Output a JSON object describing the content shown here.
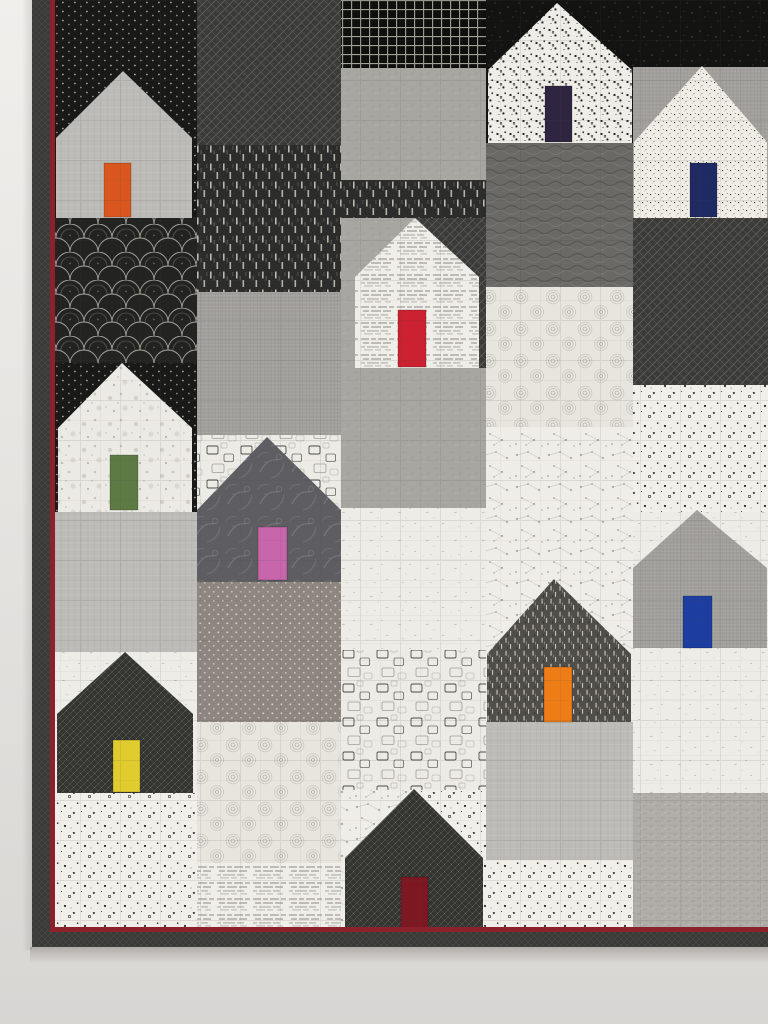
{
  "scene": {
    "description": "Photograph of a modern patchwork quilt hanging on a pale wall: rows of house blocks pieced from black, white and gray printed fabrics, each house with a single bright colored door; dark binding with thin dark-red piping on left and bottom edges",
    "wall": {
      "top_color": "#f0efec",
      "bottom_color": "#d8d6d3"
    },
    "piping_color": "#8c212c",
    "quilt": {
      "cells": [
        {
          "x": 55,
          "y": 0,
          "w": 142,
          "h": 218,
          "fabric": "blackDots"
        },
        {
          "x": 55,
          "y": 218,
          "w": 142,
          "h": 145,
          "fabric": "clamshell"
        },
        {
          "x": 55,
          "y": 363,
          "w": 142,
          "h": 149,
          "fabric": "blackDots"
        },
        {
          "x": 55,
          "y": 512,
          "w": 142,
          "h": 140,
          "fabric": "lightGrayX"
        },
        {
          "x": 55,
          "y": 652,
          "w": 142,
          "h": 141,
          "fabric": "whiteFleck"
        },
        {
          "x": 55,
          "y": 793,
          "w": 142,
          "h": 135,
          "fabric": "confetti"
        },
        {
          "x": 197,
          "y": 0,
          "w": 144,
          "h": 145,
          "fabric": "diagCross"
        },
        {
          "x": 197,
          "y": 145,
          "w": 144,
          "h": 147,
          "fabric": "bamboo"
        },
        {
          "x": 197,
          "y": 292,
          "w": 144,
          "h": 143,
          "fabric": "grayLinen"
        },
        {
          "x": 197,
          "y": 435,
          "w": 144,
          "h": 147,
          "fabric": "squaresWhite"
        },
        {
          "x": 197,
          "y": 582,
          "w": 144,
          "h": 140,
          "fabric": "taupeDots"
        },
        {
          "x": 197,
          "y": 722,
          "w": 144,
          "h": 141,
          "fabric": "swirl"
        },
        {
          "x": 197,
          "y": 863,
          "w": 144,
          "h": 65,
          "fabric": "textPrint"
        },
        {
          "x": 341,
          "y": 0,
          "w": 145,
          "h": 68,
          "fabric": "gridBlack"
        },
        {
          "x": 341,
          "y": 68,
          "w": 145,
          "h": 112,
          "fabric": "grayFleckMed"
        },
        {
          "x": 341,
          "y": 180,
          "w": 145,
          "h": 38,
          "fabric": "bamboo"
        },
        {
          "x": 341,
          "y": 218,
          "w": 74,
          "h": 150,
          "fabric": "grayFleckMed"
        },
        {
          "x": 415,
          "y": 218,
          "w": 71,
          "h": 150,
          "fabric": "diagCross"
        },
        {
          "x": 341,
          "y": 368,
          "w": 145,
          "h": 140,
          "fabric": "grayFleckMed"
        },
        {
          "x": 341,
          "y": 508,
          "w": 145,
          "h": 142,
          "fabric": "whiteFleck"
        },
        {
          "x": 341,
          "y": 650,
          "w": 145,
          "h": 140,
          "fabric": "squaresWhite"
        },
        {
          "x": 341,
          "y": 790,
          "w": 73,
          "h": 138,
          "fabric": "constellation"
        },
        {
          "x": 414,
          "y": 790,
          "w": 72,
          "h": 138,
          "fabric": "confetti"
        },
        {
          "x": 486,
          "y": 0,
          "w": 147,
          "h": 143,
          "fabric": "blackSpeckle"
        },
        {
          "x": 486,
          "y": 143,
          "w": 147,
          "h": 144,
          "fabric": "darkScribble"
        },
        {
          "x": 486,
          "y": 287,
          "w": 147,
          "h": 140,
          "fabric": "swirl"
        },
        {
          "x": 486,
          "y": 427,
          "w": 147,
          "h": 295,
          "fabric": "constellation"
        },
        {
          "x": 486,
          "y": 722,
          "w": 147,
          "h": 138,
          "fabric": "lightGrayX"
        },
        {
          "x": 486,
          "y": 860,
          "w": 147,
          "h": 68,
          "fabric": "confetti"
        },
        {
          "x": 633,
          "y": 0,
          "w": 135,
          "h": 67,
          "fabric": "blackSpeckle"
        },
        {
          "x": 633,
          "y": 67,
          "w": 135,
          "h": 151,
          "fabric": "grayLinen"
        },
        {
          "x": 633,
          "y": 218,
          "w": 135,
          "h": 167,
          "fabric": "diagCross"
        },
        {
          "x": 633,
          "y": 385,
          "w": 135,
          "h": 127,
          "fabric": "confetti"
        },
        {
          "x": 633,
          "y": 512,
          "w": 135,
          "h": 281,
          "fabric": "whiteFleck"
        },
        {
          "x": 633,
          "y": 793,
          "w": 135,
          "h": 135,
          "fabric": "grayDash"
        }
      ],
      "houses": [
        {
          "name": "house-1-orange-door",
          "xL": 56,
          "xR": 192,
          "peakX": 123,
          "peakY": 71,
          "eave": 138,
          "bottom": 218,
          "fabric": "lightGrayX",
          "door": {
            "x": 104,
            "y": 163,
            "w": 27,
            "h": 54,
            "color": "#d9571e"
          }
        },
        {
          "name": "house-2-purple-door",
          "xL": 488,
          "xR": 632,
          "peakX": 557,
          "peakY": 3,
          "eave": 70,
          "bottom": 143,
          "fabric": "confettiDense",
          "door": {
            "x": 545,
            "y": 86,
            "w": 27,
            "h": 56,
            "color": "#2f2540"
          }
        },
        {
          "name": "house-3-navy-door",
          "xL": 634,
          "xR": 767,
          "peakX": 702,
          "peakY": 66,
          "eave": 142,
          "bottom": 218,
          "fabric": "tinyDots",
          "door": {
            "x": 690,
            "y": 163,
            "w": 27,
            "h": 54,
            "color": "#1f2a63"
          }
        },
        {
          "name": "house-4-green-door",
          "xL": 58,
          "xR": 192,
          "peakX": 122,
          "peakY": 363,
          "eave": 428,
          "bottom": 512,
          "fabric": "whiteSpeckle",
          "door": {
            "x": 110,
            "y": 455,
            "w": 28,
            "h": 55,
            "color": "#5e7a44"
          }
        },
        {
          "name": "house-5-pink-door",
          "xL": 197,
          "xR": 341,
          "peakX": 267,
          "peakY": 437,
          "eave": 510,
          "bottom": 582,
          "fabric": "batik",
          "door": {
            "x": 258,
            "y": 527,
            "w": 29,
            "h": 53,
            "color": "#c766ab"
          }
        },
        {
          "name": "house-6-yellow-door",
          "xL": 57,
          "xR": 193,
          "peakX": 125,
          "peakY": 652,
          "eave": 714,
          "bottom": 793,
          "fabric": "darkFineX",
          "door": {
            "x": 113,
            "y": 740,
            "w": 27,
            "h": 52,
            "color": "#e0cc2e"
          }
        },
        {
          "name": "house-7-orange-door",
          "xL": 487,
          "xR": 631,
          "peakX": 554,
          "peakY": 579,
          "eave": 654,
          "bottom": 722,
          "fabric": "darkDash",
          "door": {
            "x": 544,
            "y": 667,
            "w": 28,
            "h": 55,
            "color": "#ee7d18"
          }
        },
        {
          "name": "house-8-blue-door",
          "xL": 633,
          "xR": 767,
          "peakX": 697,
          "peakY": 510,
          "eave": 568,
          "bottom": 648,
          "fabric": "grayLinen",
          "door": {
            "x": 683,
            "y": 596,
            "w": 29,
            "h": 52,
            "color": "#1e3da0"
          }
        },
        {
          "name": "house-9-maroon-door",
          "xL": 345,
          "xR": 483,
          "peakX": 414,
          "peakY": 789,
          "eave": 858,
          "bottom": 928,
          "fabric": "darkFineX",
          "door": {
            "x": 401,
            "y": 877,
            "w": 27,
            "h": 51,
            "color": "#7d1822"
          }
        },
        {
          "name": "house-10-red-door",
          "xL": 355,
          "xR": 479,
          "peakX": 415,
          "peakY": 218,
          "eave": 277,
          "bottom": 368,
          "fabric": "textPrint",
          "door": {
            "x": 398,
            "y": 310,
            "w": 28,
            "h": 57,
            "color": "#cc2130"
          }
        }
      ],
      "piping": [
        {
          "x": 50,
          "y": 0,
          "w": 5,
          "h": 930
        },
        {
          "x": 50,
          "y": 927,
          "w": 718,
          "h": 5
        }
      ],
      "binding": [
        {
          "x": 32,
          "y": 0,
          "w": 18,
          "h": 947,
          "fabric": "bindingDark"
        },
        {
          "x": 32,
          "y": 932,
          "w": 736,
          "h": 15,
          "fabric": "bindingDark"
        }
      ]
    }
  }
}
